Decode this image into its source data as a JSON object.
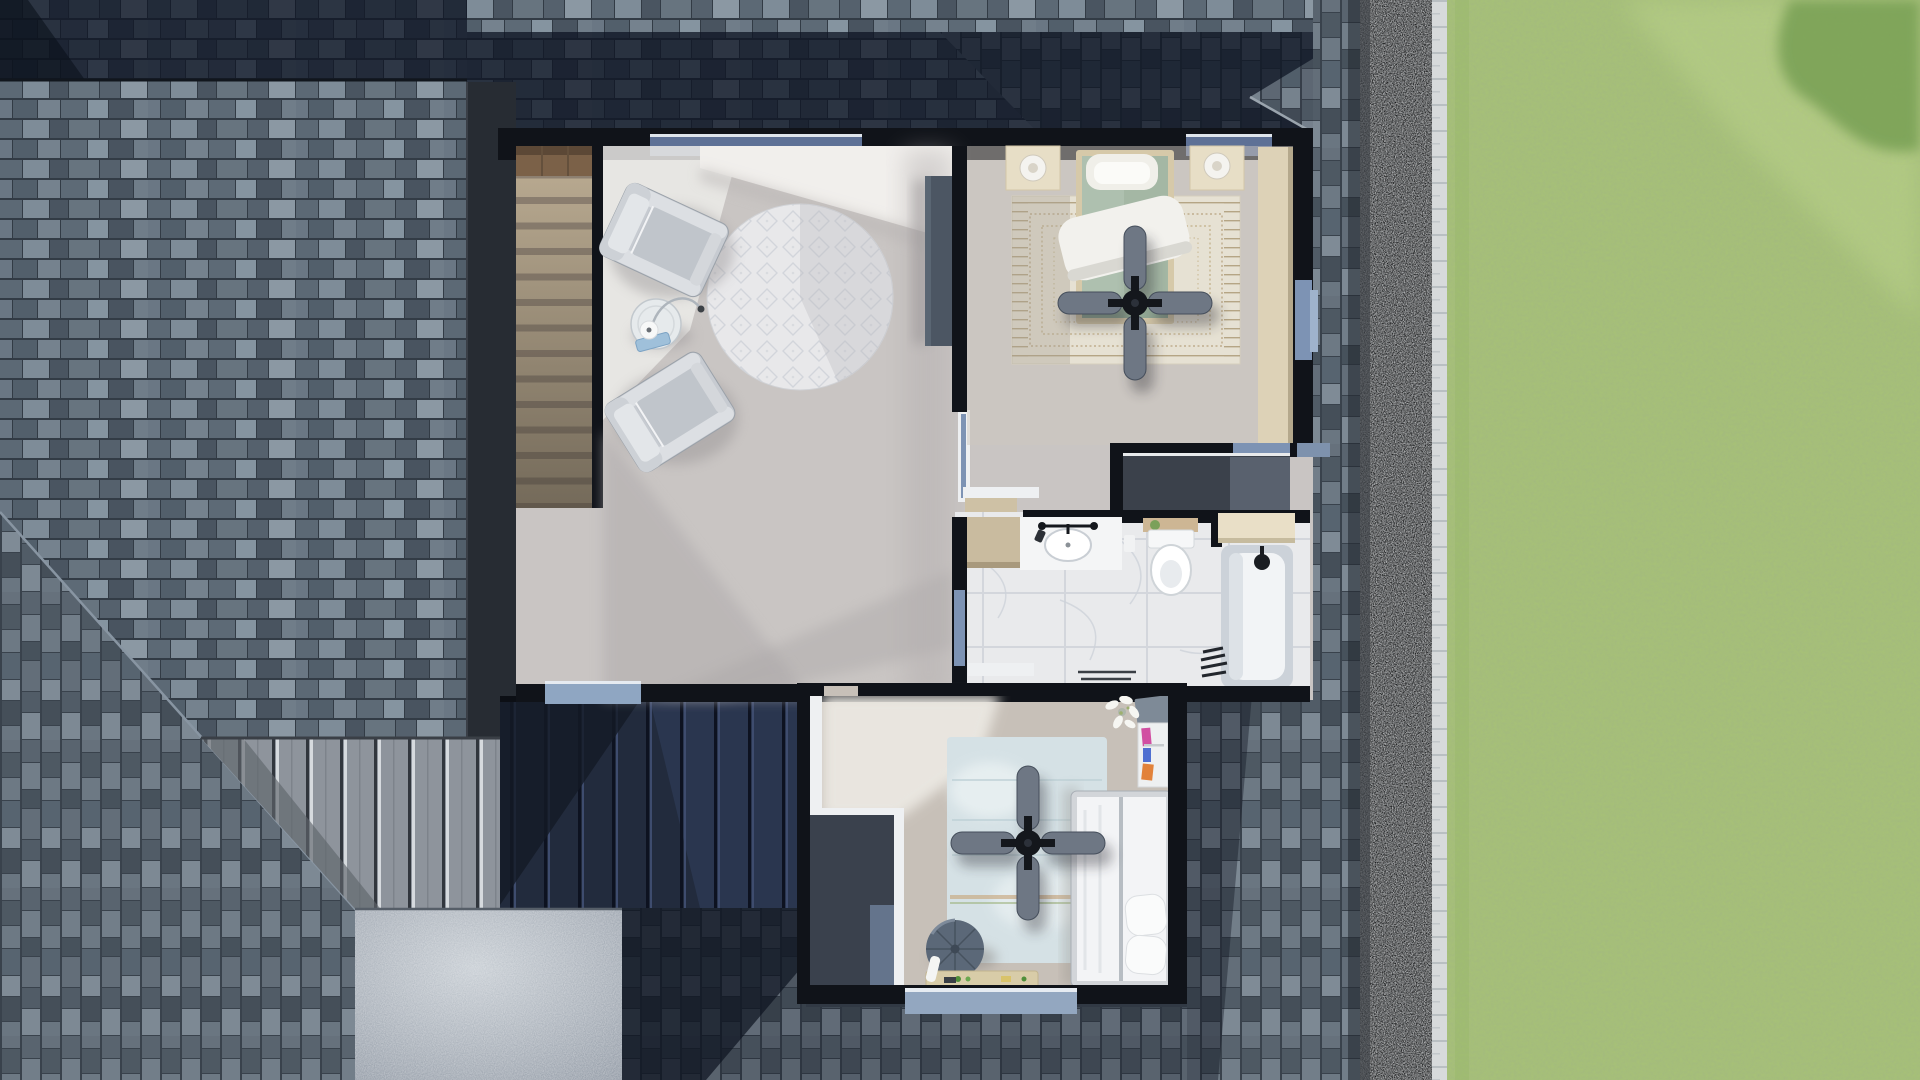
{
  "scene": {
    "kind": "architectural-3d-render",
    "view": "top-down dollhouse cutaway of upper floor",
    "has_visible_text": false
  },
  "palette": {
    "lawn": "#a6c078",
    "lawn_shadow": "#6f9a4e",
    "curb": "#d7dadb",
    "gravel": "#6d7276",
    "wall": "#101319",
    "fascia": "#272c33",
    "floor": "#c9c5c3",
    "floor_bedroom2": "#c7c0b8",
    "marble": "#e9eaec",
    "closet_floor": "#3b414b",
    "metal_roof_navy": "#222b3d",
    "metal_roof_gray": "#8e949c",
    "patio": "#b3bac2",
    "window_glass": "#7d93b4",
    "window_glass_top": "#5e7196",
    "window_sill": "#8fa6c2",
    "trim_white": "#eef0f2",
    "cream": "#e7dec6",
    "stair_wood": "#7b6148",
    "stair_carpet": "#b7a88f",
    "bed1_duvet": "#aec0af",
    "bed2_duvet": "#f3f4f6",
    "rug_round": "#e8e8ea",
    "rug_bedroom1": "#e6e1d3",
    "rug_bedroom2": "#d5e1e5",
    "fan_blade": "#6e7784",
    "pouf": "#5b6878",
    "console": "#4c5663",
    "chair": "#c7cbd1",
    "shingle_base": "#4d5662",
    "shingle_shadow": "#0c1322"
  },
  "exterior": {
    "elements": [
      "shingle-roof-west",
      "shingle-roof-top-band",
      "shingle-roof-east",
      "shingle-roof-south",
      "standing-seam-roof-navy",
      "standing-seam-roof-gray",
      "concrete-patio",
      "gravel-border",
      "stone-curb",
      "lawn",
      "tree-shadow"
    ]
  },
  "rooms": [
    {
      "id": "stairwell",
      "label": "staircase",
      "furniture": [
        "wood-landing",
        "carpeted-steps"
      ]
    },
    {
      "id": "sitting-area",
      "label": "loft sitting area",
      "furniture": [
        "armchair-1",
        "armchair-2",
        "glass-side-table",
        "arc-lamp",
        "round-diamond-rug",
        "media-console",
        "stair-railing"
      ]
    },
    {
      "id": "bedroom-1",
      "label": "bedroom with green bed",
      "furniture": [
        "bed-green",
        "white-throw",
        "pillows",
        "nightstand-left",
        "nightstand-right",
        "table-lamp-left",
        "table-lamp-right",
        "border-rug",
        "ceiling-fan",
        "built-in-wardrobe"
      ]
    },
    {
      "id": "closet",
      "label": "walk-in closet",
      "furniture": []
    },
    {
      "id": "bathroom",
      "label": "bathroom",
      "furniture": [
        "vanity",
        "sink",
        "faucet",
        "wood-cabinet",
        "toilet",
        "wood-tray",
        "bathtub",
        "shower-head",
        "cream-shelf",
        "waste-bin",
        "bath-mat",
        "towels",
        "bench"
      ]
    },
    {
      "id": "bedroom-2",
      "label": "bedroom with white bed",
      "furniture": [
        "bed-white",
        "pillows",
        "distressed-blue-rug",
        "round-pouf",
        "toy-bench",
        "bookshelf",
        "orchid-plant",
        "ceiling-fan"
      ]
    }
  ],
  "windows": [
    "top-wall-window-sitting",
    "top-wall-window-bedroom1",
    "east-wall-window-bedroom1",
    "bathroom-glass-panel",
    "sitting-south-window",
    "bedroom2-south-window",
    "bedroom1-transom",
    "bedroom2-door-transom"
  ]
}
